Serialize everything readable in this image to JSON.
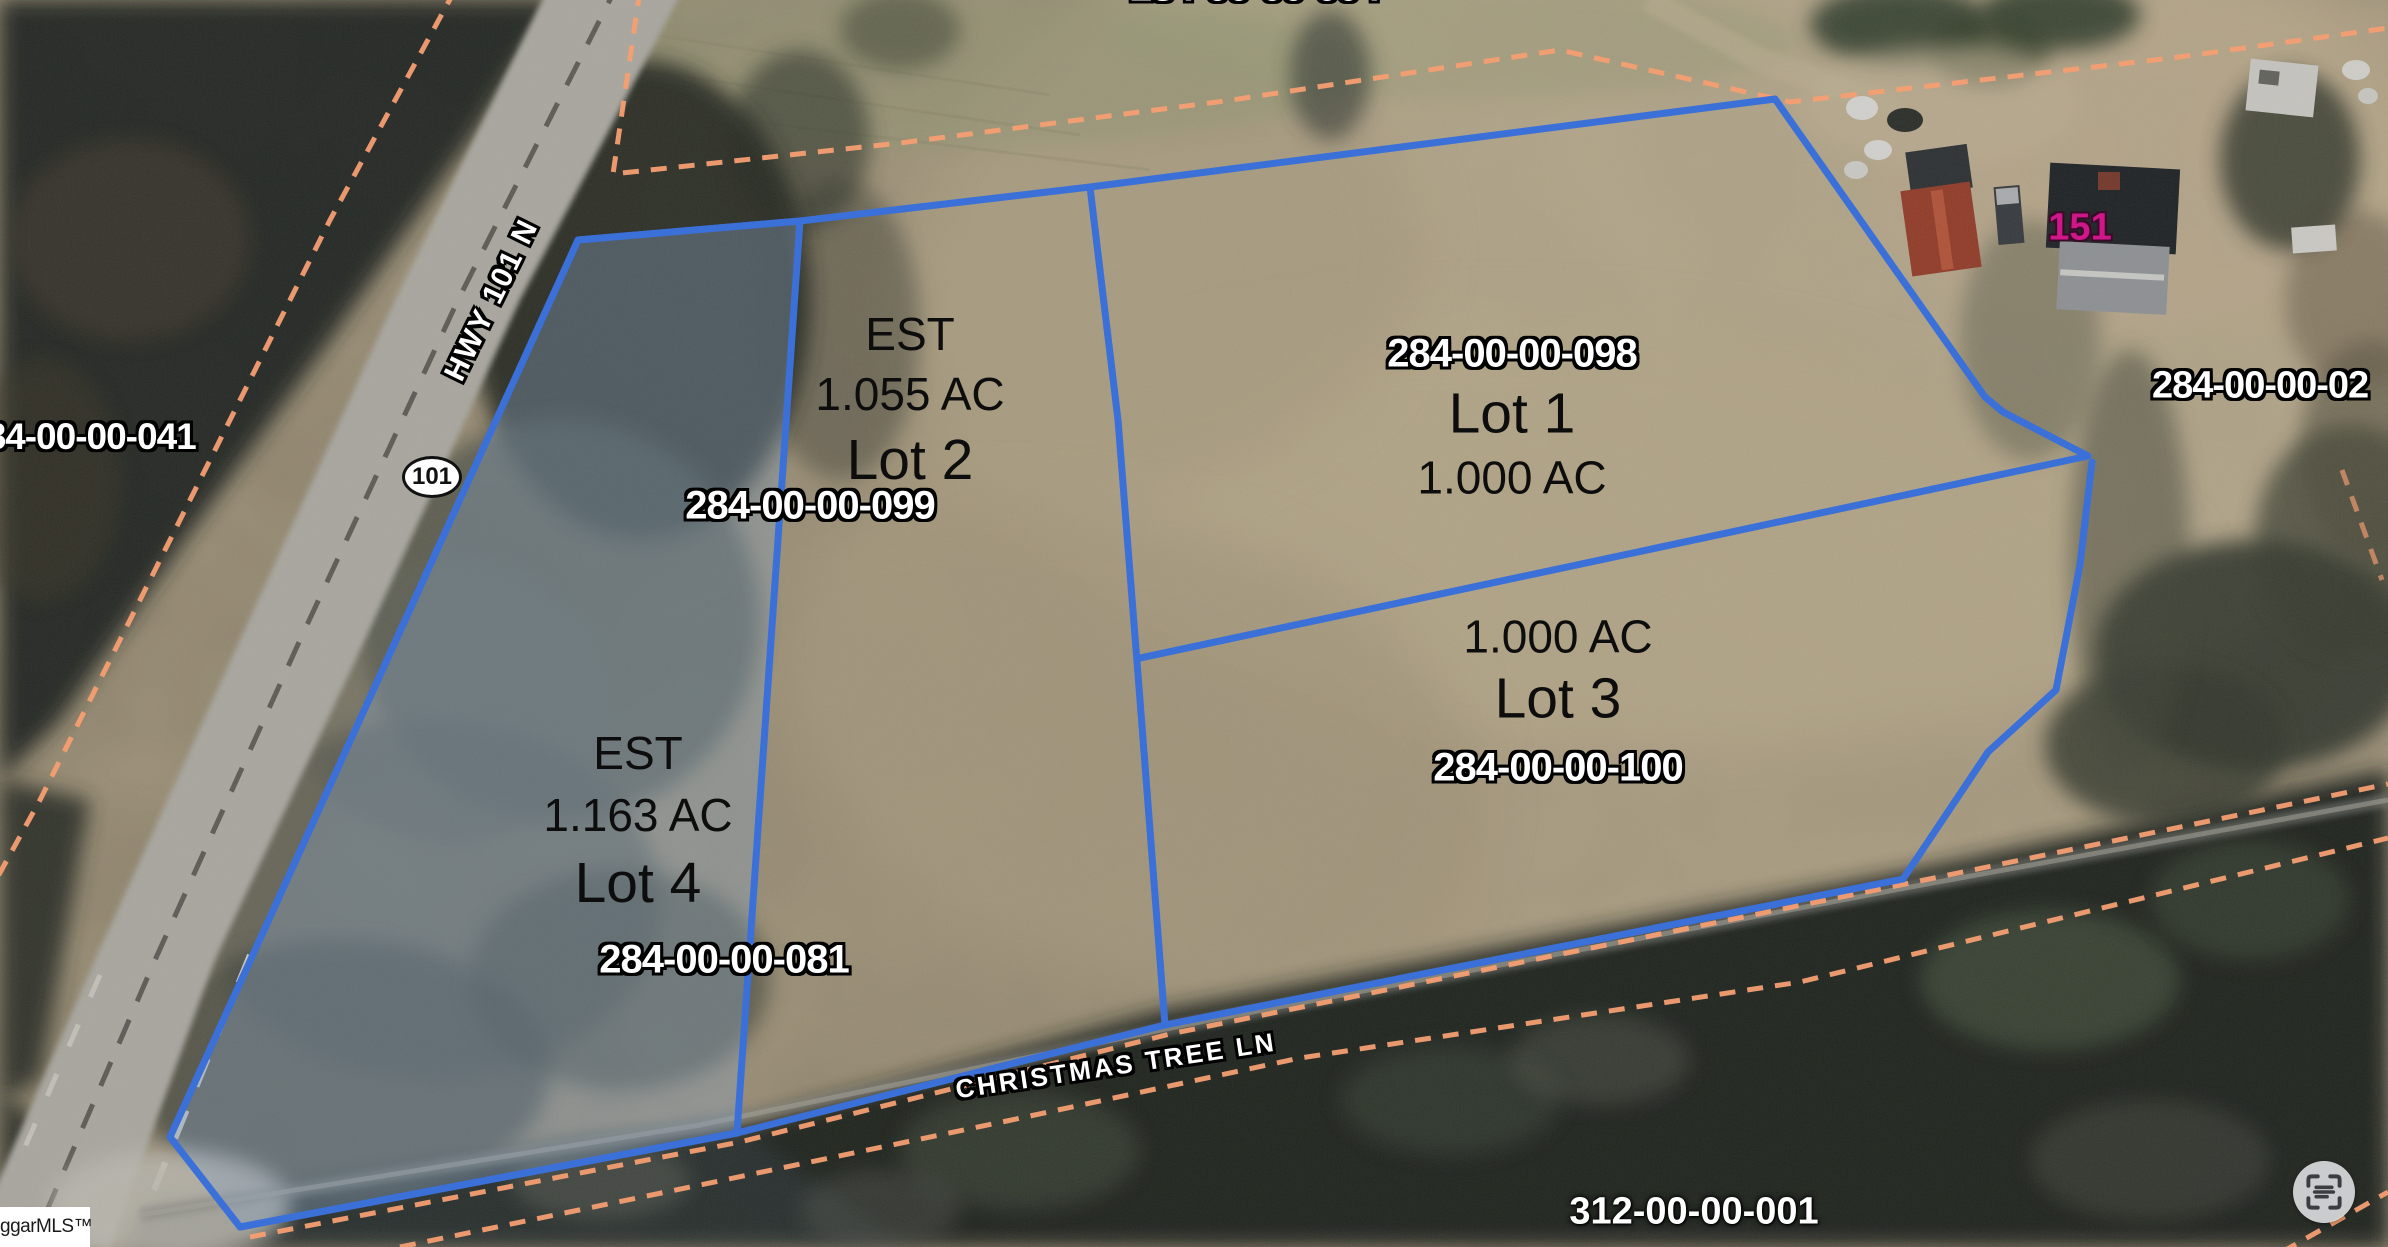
{
  "lots": [
    {
      "id": "lot1",
      "name": "Lot 1",
      "acreage": "1.000 AC",
      "parcel": "284-00-00-098"
    },
    {
      "id": "lot2",
      "est": "EST",
      "acreage": "1.055 AC",
      "name": "Lot 2",
      "parcel": "284-00-00-099"
    },
    {
      "id": "lot3",
      "acreage": "1.000 AC",
      "name": "Lot 3",
      "parcel": "284-00-00-100"
    },
    {
      "id": "lot4",
      "est": "EST",
      "acreage": "1.163 AC",
      "name": "Lot 4",
      "parcel": "284-00-00-081"
    }
  ],
  "neighbor_parcels": {
    "left": "284-00-00-041",
    "right": "284-00-00-02",
    "bottom": "312-00-00-001",
    "top": "284-00-00-004",
    "notes": "left label clipped at left edge; right label clipped at right edge; top label almost fully cut off by top edge (only glyph bottoms visible)"
  },
  "roads": {
    "highway": "HWY 101 N",
    "route_shield": "101",
    "street": "CHRISTMAS TREE LN"
  },
  "annotations": {
    "house_number": "151"
  },
  "watermark": {
    "text": "ggarMLS™",
    "icon": "house-icon",
    "note": "logo clipped at left edge"
  },
  "controls": {
    "scan_button_icon": "scan-text-icon"
  },
  "colors": {
    "lot_boundary_blue": "#3b70d9",
    "parcel_line_orange": "#f59e72",
    "lot4_highlight": "rgba(135,160,190,0.38)",
    "house_number_magenta": "#cf1789",
    "label_white": "#ffffff",
    "label_black": "#111111",
    "field_tan": "#b5a78a",
    "forest_dark": "#20241d"
  }
}
